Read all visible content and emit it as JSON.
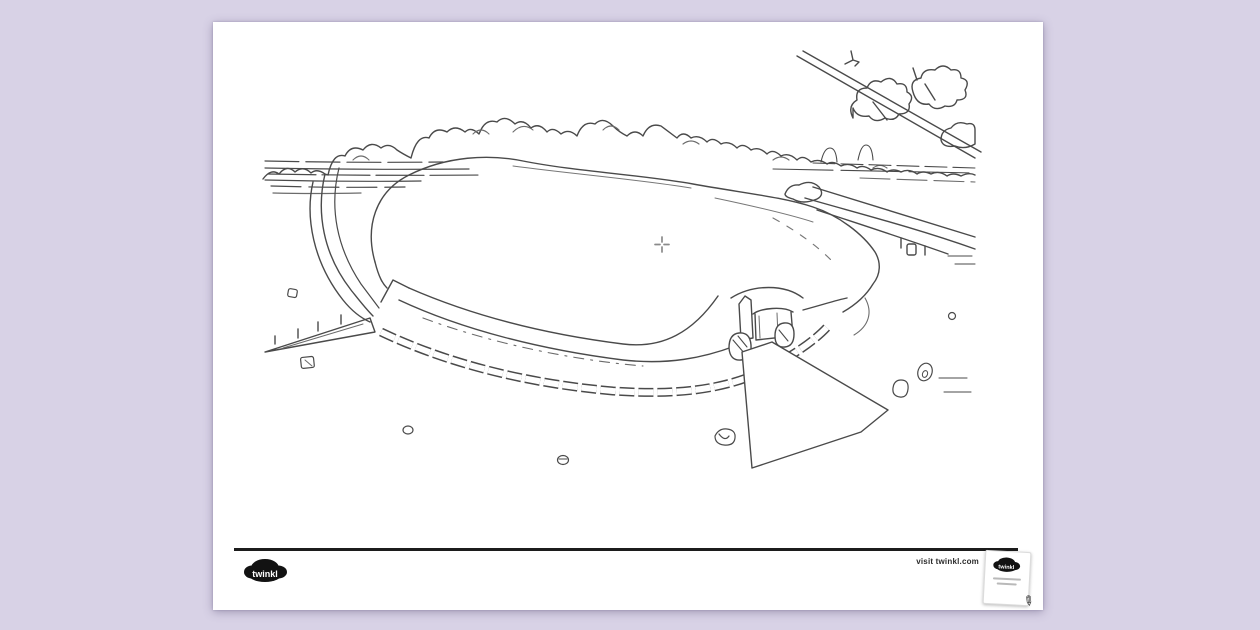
{
  "canvas": {
    "background_color": "#d8d2e6",
    "paper_color": "#ffffff",
    "line_color": "#4a4a4a"
  },
  "artwork": {
    "subject": "Black and white colouring page line drawing of a large round passage tomb mound with kerbstones at its base, a stone entrance with standing stones, an apron path, fences and paths on both sides, a treeline and field behind, an overhanging branch, and small scattered stones",
    "cursor": "crosshair"
  },
  "footer": {
    "divider_color": "#1c1c1c",
    "logo_text": "twinkl",
    "visit_text": "visit twinkl.com",
    "badge": {
      "logo_text": "twinkl",
      "pencil_icon": "✎"
    }
  }
}
